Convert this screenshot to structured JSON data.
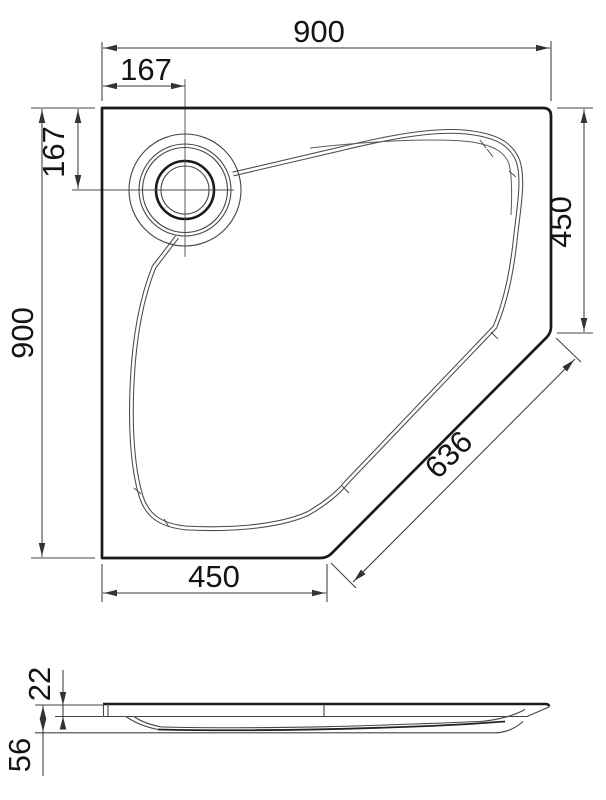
{
  "plan_view": {
    "top_width": "900",
    "drain_offset_horizontal": "167",
    "drain_offset_vertical": "167",
    "left_height": "900",
    "right_side": "450",
    "diagonal_edge": "636",
    "bottom_side": "450"
  },
  "side_view": {
    "rim_thickness": "22",
    "overall_height": "56"
  },
  "colors": {
    "background": "#ffffff",
    "thin_line": "#454545",
    "bold_line": "#1a1a1a",
    "dimension_line": "#333333",
    "text": "#141414"
  }
}
